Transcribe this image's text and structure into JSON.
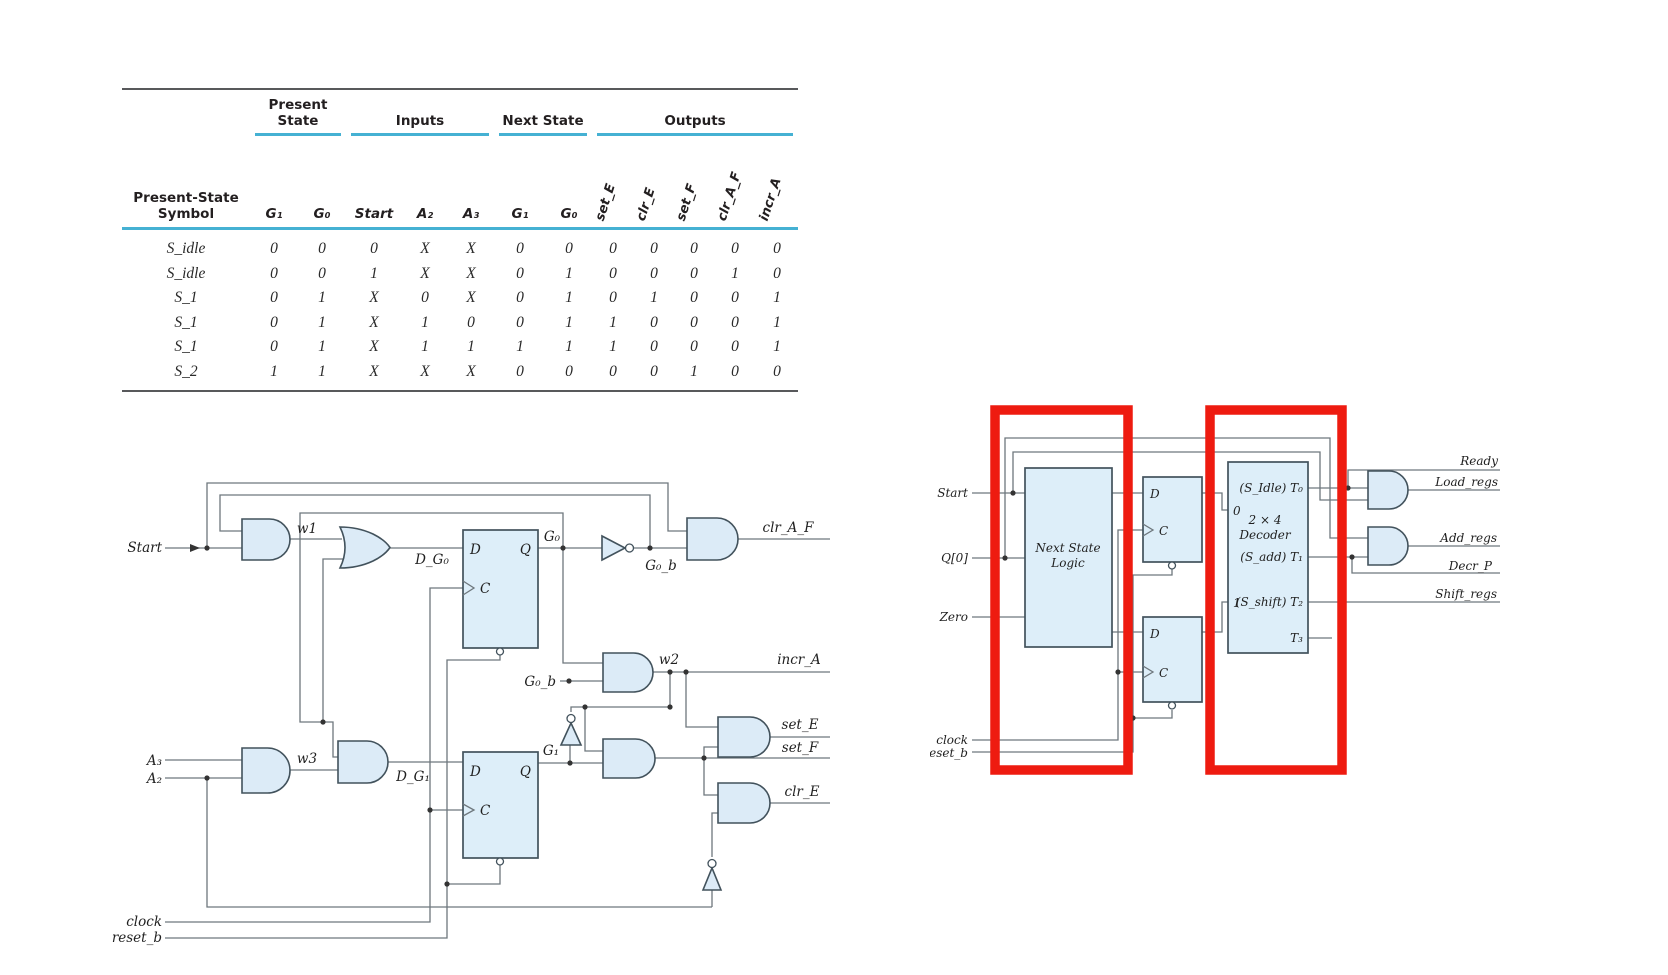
{
  "table": {
    "symbol_header": "Present-State Symbol",
    "groups": {
      "present": "Present State",
      "inputs": "Inputs",
      "next": "Next State",
      "outputs": "Outputs"
    },
    "columns": [
      "G₁",
      "G₀",
      "Start",
      "A₂",
      "A₃",
      "G₁",
      "G₀"
    ],
    "output_columns": [
      "set_E",
      "clr_E",
      "set_F",
      "clr_A_F",
      "incr_A"
    ],
    "rows": [
      {
        "symbol": "S_idle",
        "cells": [
          "0",
          "0",
          "0",
          "X",
          "X",
          "0",
          "0",
          "0",
          "0",
          "0",
          "0",
          "0"
        ]
      },
      {
        "symbol": "S_idle",
        "cells": [
          "0",
          "0",
          "1",
          "X",
          "X",
          "0",
          "1",
          "0",
          "0",
          "0",
          "1",
          "0"
        ]
      },
      {
        "symbol": "S_1",
        "cells": [
          "0",
          "1",
          "X",
          "0",
          "X",
          "0",
          "1",
          "0",
          "1",
          "0",
          "0",
          "1"
        ]
      },
      {
        "symbol": "S_1",
        "cells": [
          "0",
          "1",
          "X",
          "1",
          "0",
          "0",
          "1",
          "1",
          "0",
          "0",
          "0",
          "1"
        ]
      },
      {
        "symbol": "S_1",
        "cells": [
          "0",
          "1",
          "X",
          "1",
          "1",
          "1",
          "1",
          "1",
          "0",
          "0",
          "0",
          "1"
        ]
      },
      {
        "symbol": "S_2",
        "cells": [
          "1",
          "1",
          "X",
          "X",
          "X",
          "0",
          "0",
          "0",
          "0",
          "1",
          "0",
          "0"
        ]
      }
    ]
  },
  "left_circuit": {
    "start": "Start",
    "w1": "w1",
    "w2": "w2",
    "w3": "w3",
    "d_g0": "D_G₀",
    "d_g1": "D_G₁",
    "g0": "G₀",
    "g0_b": "G₀_b",
    "g1": "G₁",
    "d": "D",
    "q": "Q",
    "c": "C",
    "clr_a_f": "clr_A_F",
    "incr_a": "incr_A",
    "set_e": "set_E",
    "set_f": "set_F",
    "clr_e": "clr_E",
    "a3": "A₃",
    "a2": "A₂",
    "clock": "clock",
    "reset_b": "reset_b"
  },
  "right_circuit": {
    "start": "Start",
    "q0": "Q[0]",
    "zero": "Zero",
    "clock": "clock",
    "reset_b": "reset_b",
    "nsl1": "Next State",
    "nsl2": "Logic",
    "dec1": "2 × 4",
    "dec2": "Decoder",
    "t0": "(S_Idle) T₀",
    "t1": "(S_add) T₁",
    "t2": "(S_shift) T₂",
    "t3": "T₃",
    "in0": "0",
    "in1": "1",
    "d": "D",
    "c": "C",
    "ready": "Ready",
    "load_regs": "Load_regs",
    "add_regs": "Add_regs",
    "decr_p": "Decr_P",
    "shift_regs": "Shift_regs"
  },
  "colors": {
    "teal_rule": "#45b1d3",
    "gate_fill": "#dcebf7",
    "wire": "#6e777d",
    "highlight_red": "#ee1b10"
  }
}
